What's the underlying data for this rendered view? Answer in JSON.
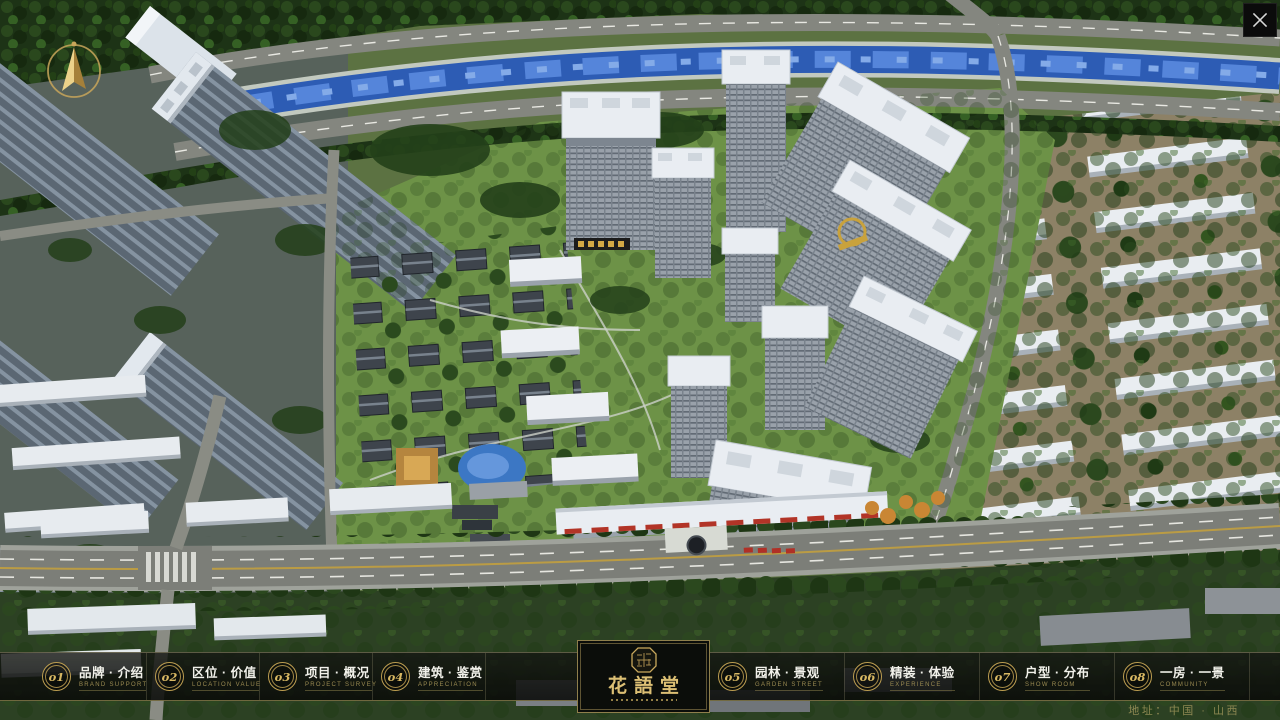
{
  "nav": {
    "items": [
      {
        "num": "o1",
        "title": "品牌 · 介绍",
        "subtitle": "BRAND SUPPORT"
      },
      {
        "num": "o2",
        "title": "区位 · 价值",
        "subtitle": "LOCATION VALUE"
      },
      {
        "num": "o3",
        "title": "项目 · 概况",
        "subtitle": "PROJECT SURVEY"
      },
      {
        "num": "o4",
        "title": "建筑 · 鉴赏",
        "subtitle": "APPRECIATION"
      },
      {
        "num": "o5",
        "title": "园林 · 景观",
        "subtitle": "GARDEN STREET"
      },
      {
        "num": "o6",
        "title": "精装 · 体验",
        "subtitle": "EXPERIENCE"
      },
      {
        "num": "o7",
        "title": "户型 · 分布",
        "subtitle": "SHOW ROOM"
      },
      {
        "num": "o8",
        "title": "一房 · 一景",
        "subtitle": "COMMUNITY"
      }
    ]
  },
  "logo": {
    "name": "花語堂"
  },
  "footer": {
    "address": "地址：中国 · 山西"
  },
  "colors": {
    "accent_gold": "#c9a85c",
    "bar_background": "rgba(16,18,15,0.84)",
    "river_blue": "#2d5cb4",
    "lawn_green": "#6d9247",
    "building_white": "#e9edf1"
  }
}
